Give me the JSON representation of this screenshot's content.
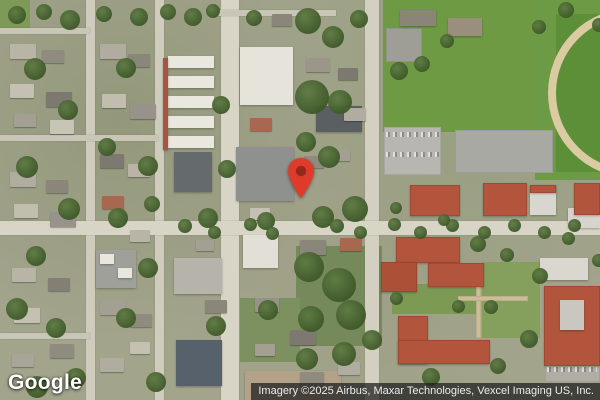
{
  "map": {
    "provider": "Google",
    "attribution": "Imagery ©2025 Airbus, Maxar Technologies, Vexcel Imaging US, Inc.",
    "marker": {
      "icon": "location-pin-icon",
      "color": "#de3b2b",
      "inner_color": "#93291c",
      "tip_x": 301,
      "tip_y": 198
    },
    "palette": {
      "street": "#d8d5c6",
      "park_green": "#6f9a44",
      "roof_red": "#b3543c",
      "track_tan": "#dbcba2",
      "attribution_bg": "#202020"
    },
    "features": [
      [
        "g",
        383,
        0,
        217,
        132,
        "#6f9a44"
      ],
      [
        "g",
        535,
        0,
        65,
        180,
        "#6d9a44"
      ],
      [
        "g",
        556,
        14,
        44,
        158,
        "#5d8f38"
      ],
      [
        "k",
        548,
        8,
        170,
        170
      ],
      [
        "g",
        0,
        0,
        30,
        34,
        "#7f9a58"
      ],
      [
        "u",
        386,
        28,
        36,
        34,
        "#9e9d96"
      ],
      [
        "g",
        392,
        284,
        88,
        30,
        "#7d9a55"
      ],
      [
        "g",
        482,
        262,
        58,
        76,
        "#85a05c"
      ],
      [
        "g",
        296,
        246,
        86,
        100,
        "#75895a"
      ],
      [
        "g",
        240,
        298,
        60,
        64,
        "#7d9060"
      ],
      [
        "u",
        384,
        127,
        57,
        48,
        "#b7b6b0"
      ],
      [
        "u",
        455,
        130,
        98,
        43,
        "#a9a9a4"
      ],
      [
        "u",
        545,
        348,
        55,
        34,
        "#b0ada4"
      ],
      [
        "u",
        476,
        266,
        5,
        72,
        "#cbbd98"
      ],
      [
        "u",
        458,
        296,
        70,
        5,
        "#cbbd98"
      ],
      [
        "s",
        86,
        0,
        9,
        400,
        "#cfccbd"
      ],
      [
        "s",
        155,
        0,
        9,
        400,
        "#cfccbd"
      ],
      [
        "s",
        221,
        0,
        18,
        400,
        "#d8d5c6"
      ],
      [
        "s",
        365,
        0,
        14,
        400,
        "#d3d0c1"
      ],
      [
        "s",
        0,
        221,
        600,
        14,
        "#d8d5c6"
      ],
      [
        "s",
        0,
        28,
        90,
        6,
        "#c9c6b8"
      ],
      [
        "s",
        0,
        135,
        158,
        6,
        "#c9c6b8"
      ],
      [
        "s",
        0,
        333,
        90,
        6,
        "#c9c6b8"
      ],
      [
        "s",
        218,
        10,
        118,
        6,
        "#c9c6b8"
      ],
      [
        "c",
        386,
        132,
        53,
        5
      ],
      [
        "c",
        386,
        152,
        53,
        5
      ],
      [
        "c",
        547,
        353,
        50,
        5
      ],
      [
        "c",
        547,
        367,
        50,
        5
      ],
      [
        "b",
        168,
        56,
        46,
        12,
        "#e9e7de"
      ],
      [
        "b",
        168,
        76,
        46,
        12,
        "#e9e7de"
      ],
      [
        "b",
        168,
        96,
        46,
        12,
        "#e9e7de"
      ],
      [
        "b",
        168,
        116,
        46,
        12,
        "#e9e7de"
      ],
      [
        "b",
        168,
        136,
        46,
        12,
        "#e9e7de"
      ],
      [
        "b",
        163,
        58,
        5,
        92,
        "#a85540"
      ],
      [
        "b",
        240,
        47,
        53,
        58,
        "#e6e4da"
      ],
      [
        "b",
        236,
        147,
        58,
        54,
        "#8f918e"
      ],
      [
        "b",
        174,
        152,
        38,
        40,
        "#656b6d"
      ],
      [
        "b",
        243,
        235,
        35,
        33,
        "#e2e0d6"
      ],
      [
        "b",
        316,
        106,
        46,
        26,
        "#5a5f62"
      ],
      [
        "b",
        176,
        340,
        46,
        46,
        "#56616c"
      ],
      [
        "b",
        174,
        258,
        48,
        36,
        "#b5b3aa"
      ],
      [
        "b",
        245,
        371,
        96,
        29,
        "#b3a288"
      ],
      [
        "b",
        96,
        250,
        40,
        38,
        "#9fa099"
      ],
      [
        "b",
        100,
        254,
        14,
        10,
        "#e8e6dd"
      ],
      [
        "b",
        118,
        268,
        14,
        10,
        "#e8e6dd"
      ],
      [
        "b",
        400,
        10,
        36,
        16,
        "#8b8478"
      ],
      [
        "b",
        448,
        18,
        34,
        18,
        "#9a8f7d"
      ],
      [
        "b",
        540,
        258,
        48,
        22,
        "#d9d7cf"
      ],
      [
        "b",
        568,
        208,
        32,
        20,
        "#d6d4cc"
      ],
      [
        "r",
        410,
        185,
        50,
        31
      ],
      [
        "r",
        483,
        183,
        44,
        33
      ],
      [
        "b",
        530,
        185,
        26,
        30,
        "#d8d6ce"
      ],
      [
        "r",
        530,
        185,
        26,
        8
      ],
      [
        "r",
        574,
        183,
        26,
        32
      ],
      [
        "r",
        396,
        237,
        64,
        26
      ],
      [
        "r",
        381,
        262,
        36,
        30,
        "#ad5038"
      ],
      [
        "r",
        428,
        263,
        56,
        24
      ],
      [
        "r",
        398,
        316,
        30,
        48
      ],
      [
        "r",
        398,
        340,
        92,
        24
      ],
      [
        "r",
        544,
        286,
        56,
        80
      ],
      [
        "b",
        560,
        300,
        24,
        30,
        "#c9c7bf"
      ],
      [
        "h",
        10,
        44,
        26,
        15,
        "#b8b4a6"
      ],
      [
        "h",
        42,
        50,
        22,
        13,
        "#8f8b7f"
      ],
      [
        "h",
        10,
        84,
        24,
        14,
        "#c4c0b2"
      ],
      [
        "h",
        46,
        92,
        26,
        15,
        "#7d7970"
      ],
      [
        "h",
        14,
        114,
        22,
        13,
        "#a39f92"
      ],
      [
        "h",
        50,
        120,
        24,
        14,
        "#c8c4b6"
      ],
      [
        "h",
        10,
        172,
        26,
        15,
        "#b0aca0"
      ],
      [
        "h",
        46,
        180,
        22,
        13,
        "#8a8679"
      ],
      [
        "h",
        14,
        204,
        24,
        14,
        "#c1bdaf"
      ],
      [
        "h",
        50,
        212,
        26,
        15,
        "#97938a"
      ],
      [
        "h",
        12,
        268,
        24,
        14,
        "#b8b4a6"
      ],
      [
        "h",
        48,
        278,
        22,
        13,
        "#837f74"
      ],
      [
        "h",
        14,
        308,
        26,
        15,
        "#c4c0b2"
      ],
      [
        "h",
        50,
        344,
        24,
        14,
        "#8f8b7f"
      ],
      [
        "h",
        12,
        354,
        22,
        13,
        "#a8a497"
      ],
      [
        "h",
        100,
        44,
        26,
        15,
        "#b0aca0"
      ],
      [
        "h",
        128,
        54,
        22,
        13,
        "#8a8679"
      ],
      [
        "h",
        102,
        94,
        24,
        14,
        "#c1bdaf"
      ],
      [
        "h",
        130,
        104,
        26,
        15,
        "#97938a"
      ],
      [
        "h",
        100,
        154,
        24,
        14,
        "#7d7970"
      ],
      [
        "h",
        128,
        164,
        22,
        13,
        "#b8b4a6"
      ],
      [
        "h",
        102,
        196,
        22,
        13,
        "#a8674f"
      ],
      [
        "h",
        100,
        300,
        26,
        15,
        "#a39f92"
      ],
      [
        "h",
        130,
        314,
        22,
        13,
        "#8f8b7f"
      ],
      [
        "h",
        100,
        358,
        24,
        14,
        "#b0aca0"
      ],
      [
        "h",
        130,
        342,
        20,
        12,
        "#c4c0b2"
      ],
      [
        "h",
        250,
        118,
        22,
        13,
        "#a8674f"
      ],
      [
        "h",
        272,
        14,
        20,
        12,
        "#8a8679"
      ],
      [
        "h",
        306,
        58,
        24,
        14,
        "#9b958a"
      ],
      [
        "h",
        338,
        68,
        20,
        12,
        "#7d7970"
      ],
      [
        "h",
        344,
        108,
        22,
        13,
        "#b0aca0"
      ],
      [
        "h",
        304,
        156,
        20,
        12,
        "#8f8b7f"
      ],
      [
        "h",
        332,
        150,
        18,
        11,
        "#a39f92"
      ],
      [
        "h",
        250,
        208,
        20,
        12,
        "#c4c0b2"
      ],
      [
        "h",
        300,
        240,
        26,
        15,
        "#8a8679"
      ],
      [
        "h",
        340,
        238,
        22,
        13,
        "#a8674f"
      ],
      [
        "h",
        255,
        298,
        24,
        14,
        "#97938a"
      ],
      [
        "h",
        290,
        330,
        26,
        15,
        "#7d7970"
      ],
      [
        "h",
        338,
        362,
        22,
        13,
        "#b0aca0"
      ],
      [
        "h",
        255,
        344,
        20,
        12,
        "#a39f92"
      ],
      [
        "h",
        300,
        372,
        24,
        14,
        "#8f8b7f"
      ],
      [
        "h",
        130,
        230,
        20,
        12,
        "#b8b4a6"
      ],
      [
        "h",
        196,
        240,
        18,
        11,
        "#a39f92"
      ],
      [
        "h",
        205,
        300,
        22,
        13,
        "#8a8679"
      ],
      [
        "t",
        295,
        8,
        26
      ],
      [
        "t",
        322,
        26,
        22
      ],
      [
        "t",
        350,
        10,
        18
      ],
      [
        "t",
        246,
        10,
        16
      ],
      [
        "t",
        295,
        80,
        34
      ],
      [
        "t",
        328,
        90,
        24
      ],
      [
        "t",
        296,
        132,
        20
      ],
      [
        "t",
        318,
        146,
        22
      ],
      [
        "t",
        342,
        196,
        26
      ],
      [
        "t",
        312,
        206,
        22
      ],
      [
        "t",
        257,
        212,
        18
      ],
      [
        "t",
        294,
        252,
        30
      ],
      [
        "t",
        322,
        268,
        34
      ],
      [
        "t",
        336,
        300,
        30
      ],
      [
        "t",
        298,
        306,
        26
      ],
      [
        "t",
        258,
        300,
        20
      ],
      [
        "t",
        332,
        342,
        24
      ],
      [
        "t",
        362,
        330,
        20
      ],
      [
        "t",
        296,
        348,
        22
      ],
      [
        "t",
        24,
        58,
        22
      ],
      [
        "t",
        58,
        100,
        20
      ],
      [
        "t",
        16,
        156,
        22
      ],
      [
        "t",
        58,
        198,
        22
      ],
      [
        "t",
        26,
        246,
        20
      ],
      [
        "t",
        6,
        298,
        22
      ],
      [
        "t",
        46,
        318,
        20
      ],
      [
        "t",
        116,
        58,
        20
      ],
      [
        "t",
        138,
        156,
        20
      ],
      [
        "t",
        108,
        208,
        20
      ],
      [
        "t",
        138,
        258,
        20
      ],
      [
        "t",
        116,
        308,
        20
      ],
      [
        "t",
        26,
        376,
        22
      ],
      [
        "t",
        66,
        368,
        20
      ],
      [
        "t",
        146,
        372,
        20
      ],
      [
        "t",
        198,
        208,
        20
      ],
      [
        "t",
        206,
        316,
        20
      ],
      [
        "t",
        98,
        138,
        18
      ],
      [
        "t",
        60,
        10,
        20
      ],
      [
        "t",
        130,
        8,
        18
      ],
      [
        "t",
        184,
        8,
        18
      ],
      [
        "t",
        212,
        96,
        18
      ],
      [
        "t",
        218,
        160,
        18
      ],
      [
        "t",
        144,
        196,
        16
      ],
      [
        "t",
        8,
        6,
        18
      ],
      [
        "t",
        36,
        4,
        16
      ],
      [
        "t",
        96,
        6,
        16
      ],
      [
        "t",
        160,
        4,
        16
      ],
      [
        "t",
        206,
        4,
        14
      ],
      [
        "t",
        178,
        219,
        14
      ],
      [
        "t",
        208,
        226,
        13
      ],
      [
        "t",
        244,
        218,
        13
      ],
      [
        "t",
        266,
        227,
        13
      ],
      [
        "t",
        330,
        219,
        14
      ],
      [
        "t",
        354,
        226,
        13
      ],
      [
        "t",
        388,
        218,
        13
      ],
      [
        "t",
        414,
        226,
        13
      ],
      [
        "t",
        446,
        219,
        13
      ],
      [
        "t",
        478,
        226,
        13
      ],
      [
        "t",
        508,
        219,
        13
      ],
      [
        "t",
        538,
        226,
        13
      ],
      [
        "t",
        568,
        219,
        13
      ],
      [
        "t",
        470,
        236,
        16
      ],
      [
        "t",
        500,
        248,
        14
      ],
      [
        "t",
        532,
        268,
        16
      ],
      [
        "t",
        484,
        300,
        14
      ],
      [
        "t",
        520,
        330,
        18
      ],
      [
        "t",
        490,
        358,
        16
      ],
      [
        "t",
        422,
        368,
        18
      ],
      [
        "t",
        452,
        300,
        13
      ],
      [
        "t",
        390,
        292,
        13
      ],
      [
        "t",
        562,
        232,
        13
      ],
      [
        "t",
        592,
        254,
        13
      ],
      [
        "t",
        390,
        202,
        12
      ],
      [
        "t",
        438,
        214,
        12
      ],
      [
        "t",
        390,
        62,
        18
      ],
      [
        "t",
        414,
        56,
        16
      ],
      [
        "t",
        440,
        34,
        14
      ],
      [
        "t",
        532,
        20,
        14
      ],
      [
        "t",
        558,
        2,
        16
      ],
      [
        "t",
        592,
        18,
        14
      ]
    ]
  }
}
